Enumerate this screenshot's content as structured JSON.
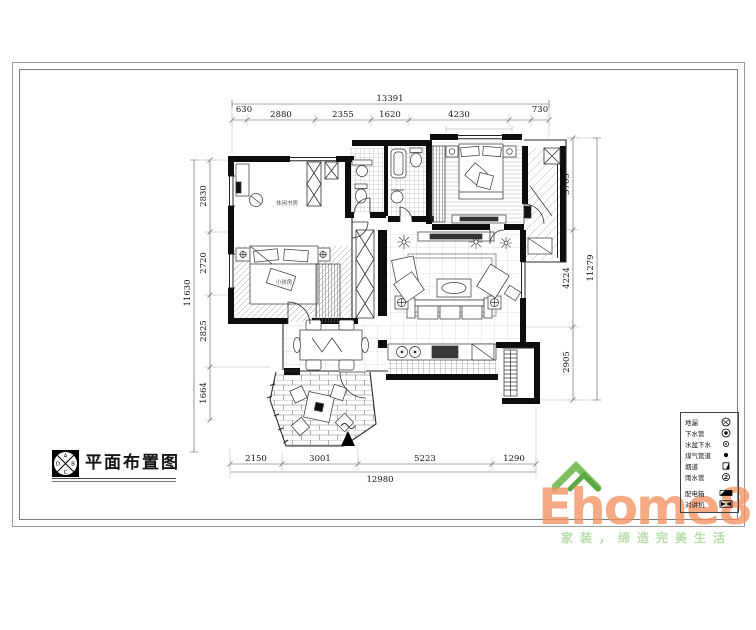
{
  "sheet": {
    "title": "平面布置图",
    "logo_letters": {
      "a": "A",
      "b": "B",
      "c": "C",
      "d": "D"
    }
  },
  "dims": {
    "top": {
      "total": "13391",
      "segments": [
        "630",
        "2880",
        "2355",
        "1620",
        "4230",
        "730"
      ]
    },
    "left": {
      "total": "11630",
      "segments": [
        "2830",
        "2720",
        "2825",
        "1664"
      ]
    },
    "right": {
      "total": "11279",
      "segments": [
        "3705",
        "4224",
        "2905"
      ]
    },
    "bottom": {
      "total": "12980",
      "segments": [
        "2150",
        "3001",
        "5223",
        "1290"
      ]
    }
  },
  "rooms": {
    "study": "休闲书房",
    "kids_bedroom": "小孩房"
  },
  "legend": {
    "labels": [
      "地漏",
      "下水管",
      "水盆下水",
      "煤气管道",
      "烟道",
      "雨水管",
      "配电箱",
      "对讲机"
    ]
  },
  "watermark": {
    "brand": "Ehome8",
    "tagline": "家装，缔造完美生活",
    "brand_color": "#f29261",
    "roof_color": "#7fc060",
    "tagline_color": "#b9dcab"
  }
}
